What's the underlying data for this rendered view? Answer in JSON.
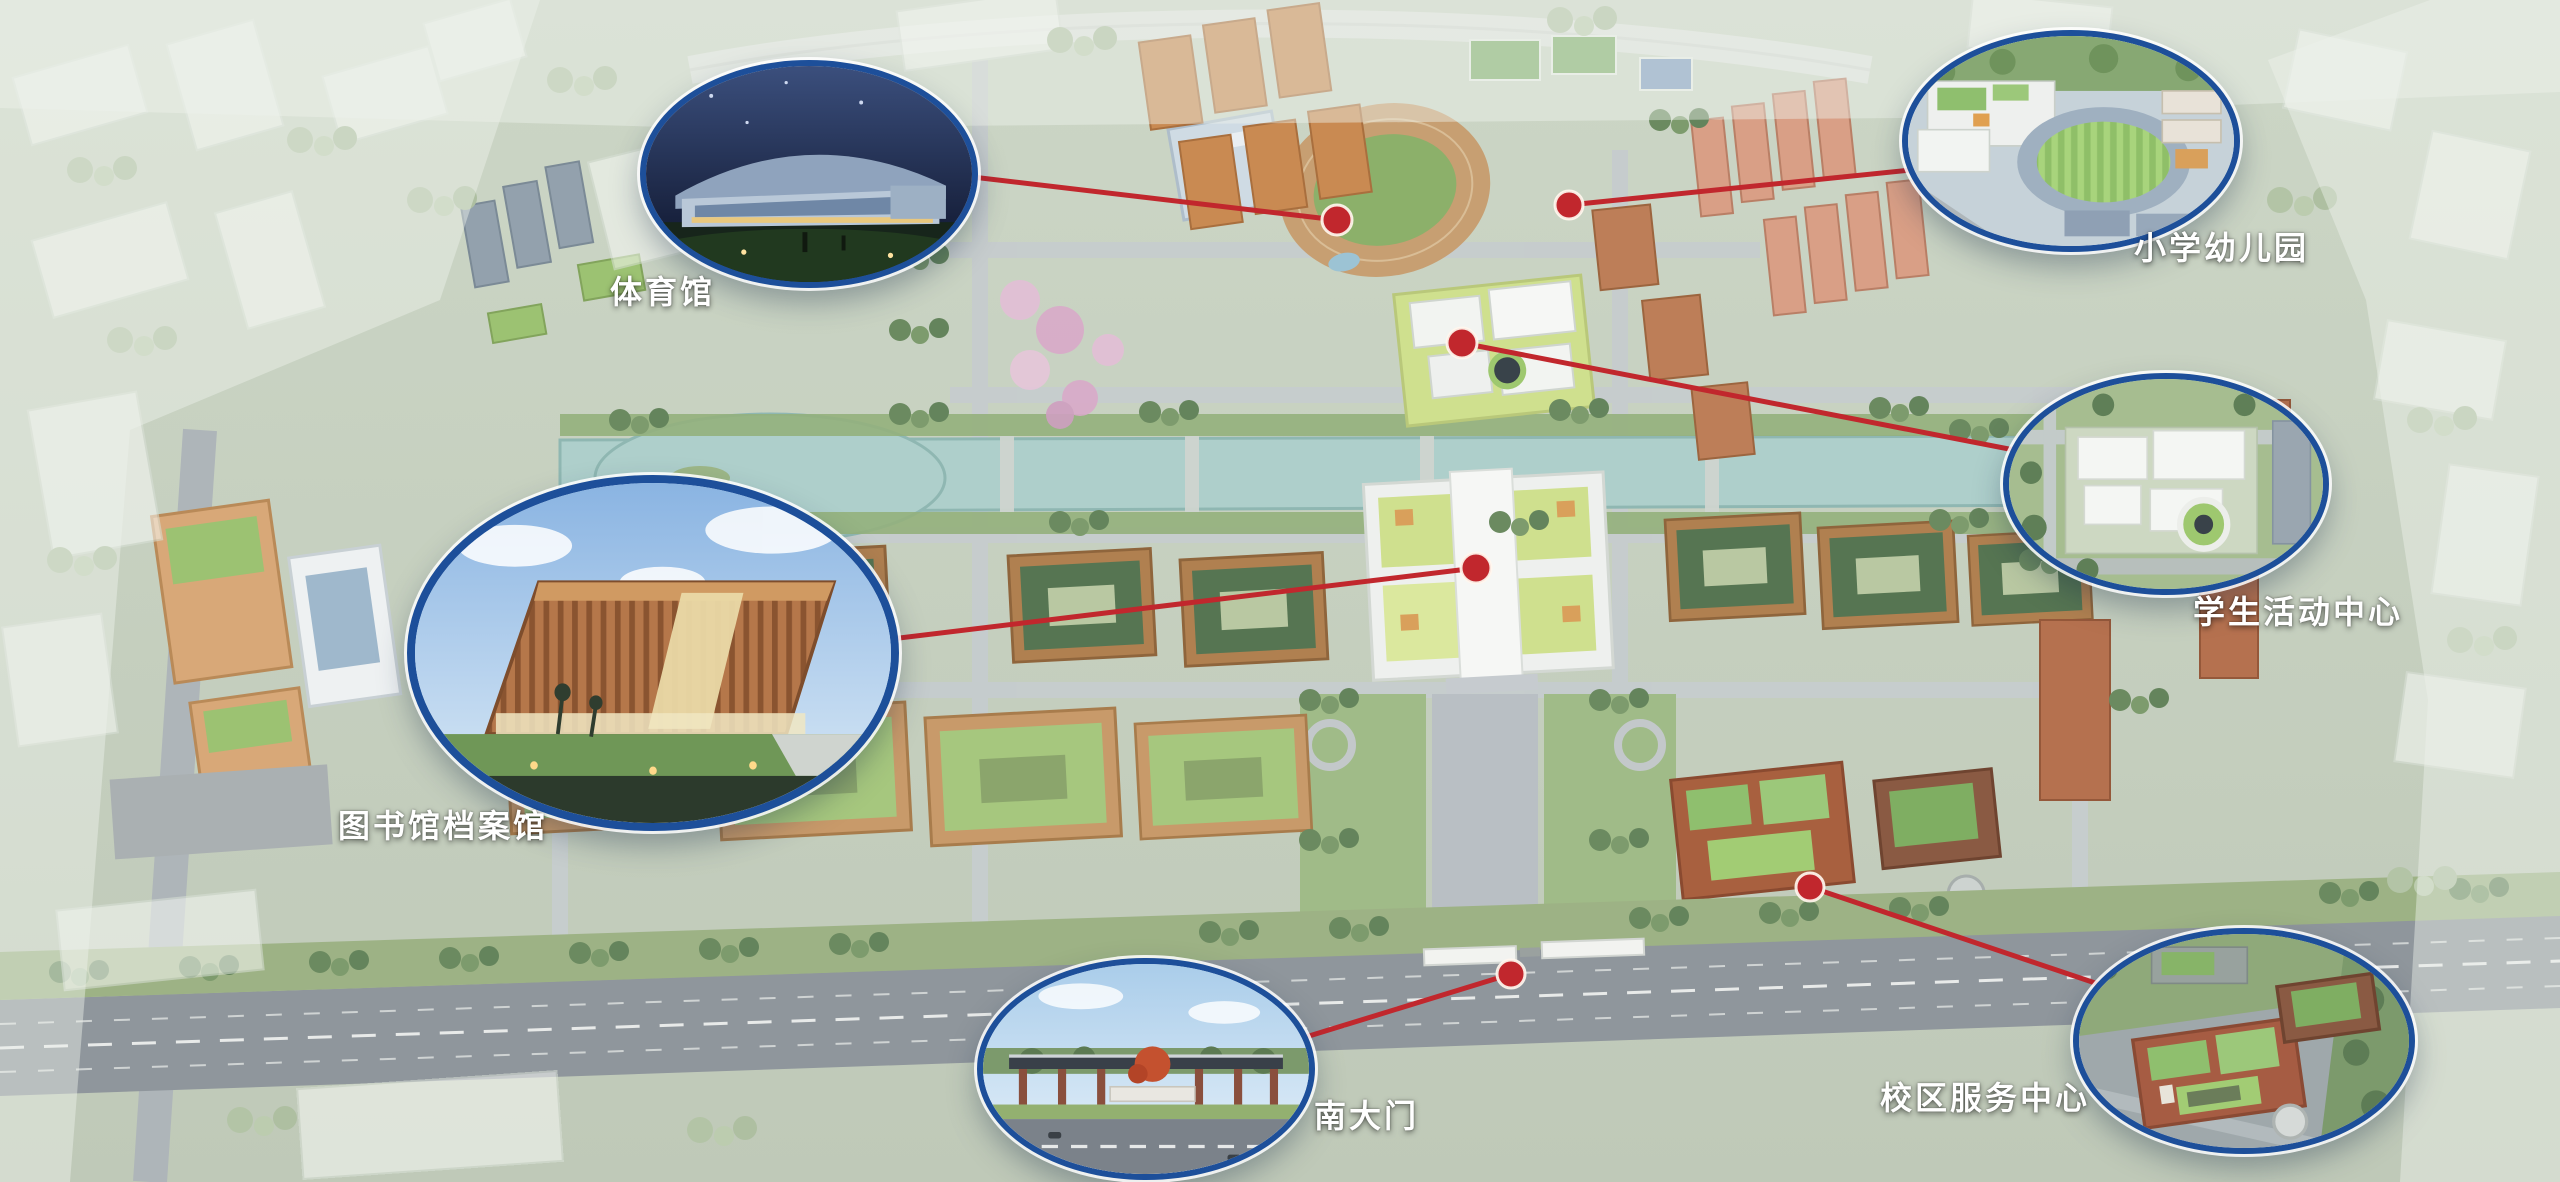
{
  "theme": {
    "accent_red": "#c1272d",
    "callout_blue": "#1d4f9a",
    "label_color": "#ffffff"
  },
  "map": {
    "type": "campus-masterplan-aerial-rendering",
    "annotation_style": "elliptical photo callouts linked by red leader lines to red site markers"
  },
  "callouts": [
    {
      "id": "gymnasium",
      "label": "体育馆"
    },
    {
      "id": "primary-school-kindergarten",
      "label": "小学幼儿园"
    },
    {
      "id": "student-activity-center",
      "label": "学生活动中心"
    },
    {
      "id": "library-archives",
      "label": "图书馆档案馆"
    },
    {
      "id": "south-gate",
      "label": "南大门"
    },
    {
      "id": "campus-service-center",
      "label": "校区服务中心"
    }
  ]
}
